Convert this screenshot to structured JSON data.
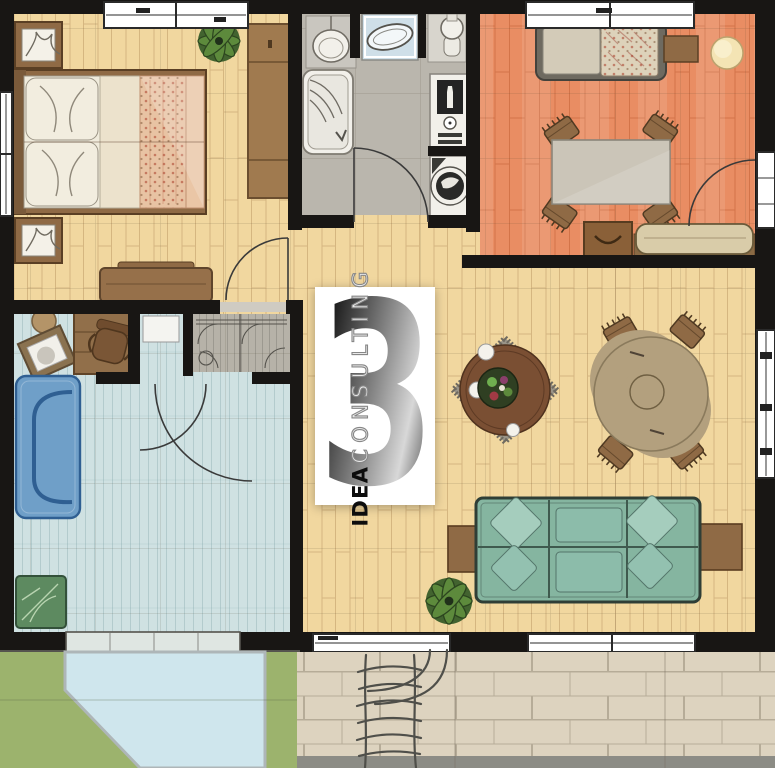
{
  "watermark": {
    "number": "3",
    "brand_bold": "IDEA",
    "brand_light": "CONSULTING"
  },
  "colors": {
    "wall": "#181614",
    "wood": "#f1d79f",
    "orange": "#e98d63",
    "bath": "#bab6ad",
    "office": "#cfe1e2",
    "closet": "#b6b2a8",
    "grass": "#9cb36d",
    "pool": "#cfe6ed",
    "stone": "#ddd3bf",
    "stone_edge": "#8c8c85",
    "sill": "#55544e",
    "furn_brown": "#8f6a45",
    "furn_brown_dark": "#5a3f24",
    "bench_tan": "#d9cca9",
    "sofa_green": "#85b5a0",
    "sofa_green_light": "#a5cdbd",
    "sofa_blue": "#6f9fc8",
    "mat_green": "#5d8a60",
    "bed_white": "#f0ebdc",
    "blanket": "#eac6a6",
    "lamp": "#f4e4b4",
    "table_gray": "#cbc5b8",
    "cloth_red": "#7c3f28",
    "table_wood": "#7a4f33",
    "table_tan": "#b3a07e",
    "fixture_white": "#f2f0ea",
    "appliance_dark": "#242424",
    "window_white": "#ffffff",
    "arc": "#3a3a3a",
    "sketch": "#4f4f4a"
  },
  "rooms": [
    {
      "id": "bedroom",
      "floor": "wood",
      "furniture": [
        "double-bed",
        "nightstand",
        "nightstand",
        "wardrobe",
        "bench",
        "plant"
      ]
    },
    {
      "id": "bathroom",
      "floor": "bath",
      "furniture": [
        "toilet",
        "vanity-sink",
        "pedestal-sink",
        "bathtub",
        "oven-column",
        "washing-machine"
      ]
    },
    {
      "id": "terracotta-room",
      "floor": "orange",
      "furniture": [
        "single-bed",
        "side-table",
        "lamp",
        "work-table",
        "chairs",
        "drawer-unit",
        "bench"
      ]
    },
    {
      "id": "office",
      "floor": "office",
      "furniture": [
        "desk",
        "office-chair",
        "stool",
        "picture-board",
        "blue-sofa",
        "green-mat"
      ]
    },
    {
      "id": "entry-closet",
      "floor": "closet",
      "furniture": [
        "wardrobe-doors"
      ]
    },
    {
      "id": "living-dining",
      "floor": "wood",
      "furniture": [
        "round-dining-table",
        "round-table-with-cloth",
        "green-sofa",
        "side-table",
        "side-table",
        "plant"
      ]
    },
    {
      "id": "terrace",
      "floor": "stone",
      "furniture": [
        "stairs-sketch"
      ]
    },
    {
      "id": "garden",
      "floor": "grass",
      "furniture": [
        "pool-path"
      ]
    }
  ]
}
